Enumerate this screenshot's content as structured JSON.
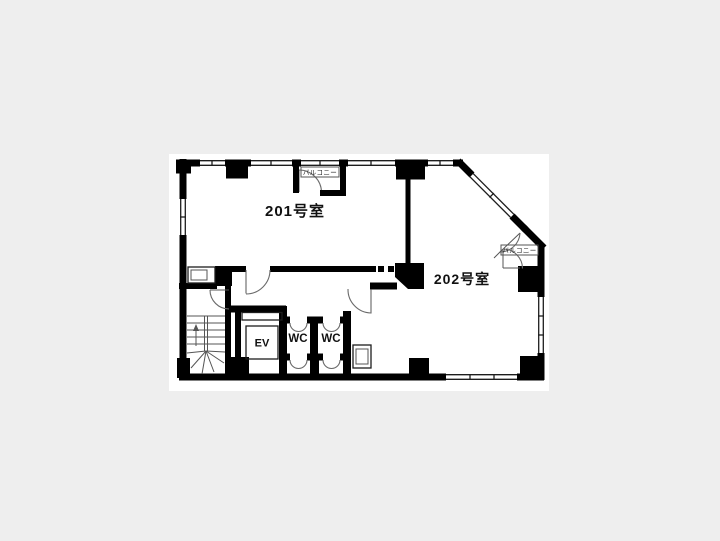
{
  "floorplan": {
    "labels": {
      "room_201": "201号室",
      "room_202": "202号室",
      "wc_left": "WC",
      "wc_right": "WC",
      "elevator": "EV",
      "balcony_north": "バルコニー",
      "balcony_east": "バルコニー"
    },
    "colors": {
      "page_background": "#eeeeee",
      "plan_paper": "#ffffff",
      "wall": "#000000"
    }
  }
}
